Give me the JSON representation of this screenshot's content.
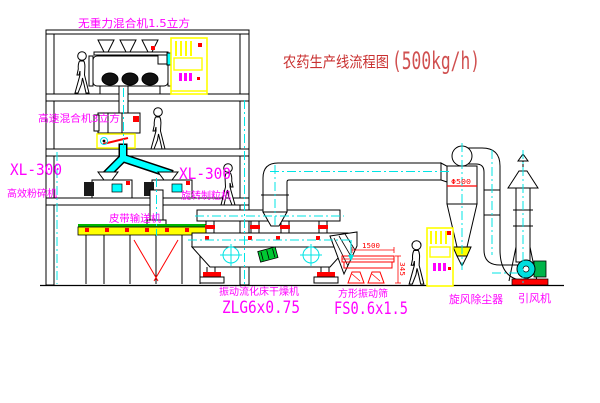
{
  "title": {
    "text_zh": "农药生产线流程图",
    "capacity": "(500kg/h)"
  },
  "equipment_labels": {
    "gravity_mixer": "无重力混合机1.5立方",
    "high_speed_mixer": "高速混合机3立方",
    "pulverizer_model": "XL-300",
    "pulverizer_name": "高效粉碎机",
    "granulator_model": "XL-300",
    "granulator_name": "旋转制粒机",
    "belt_conveyor": "皮带输送机",
    "dryer_name": "振动流化床干燥机",
    "dryer_model": "ZLG6x0.75",
    "screen_name": "方形振动筛",
    "screen_model": "FS0.6x1.5",
    "cyclone_name": "旋风除尘器",
    "fan_name": "引风机"
  },
  "dimensions": {
    "screen_length": "1500",
    "screen_height": "345",
    "cyclone_note": "Φ500"
  },
  "colors": {
    "background": "#ffffff",
    "line_black": "#000000",
    "label_magenta": "#ff00ff",
    "title_red": "#c93030",
    "capacity_red": "#d05050",
    "accent_red": "#ff0000",
    "centerline_cyan": "#00e5e5",
    "pipe_cyan": "#00ffff",
    "panel_yellow": "#ffff00",
    "accent_green": "#00c000"
  }
}
